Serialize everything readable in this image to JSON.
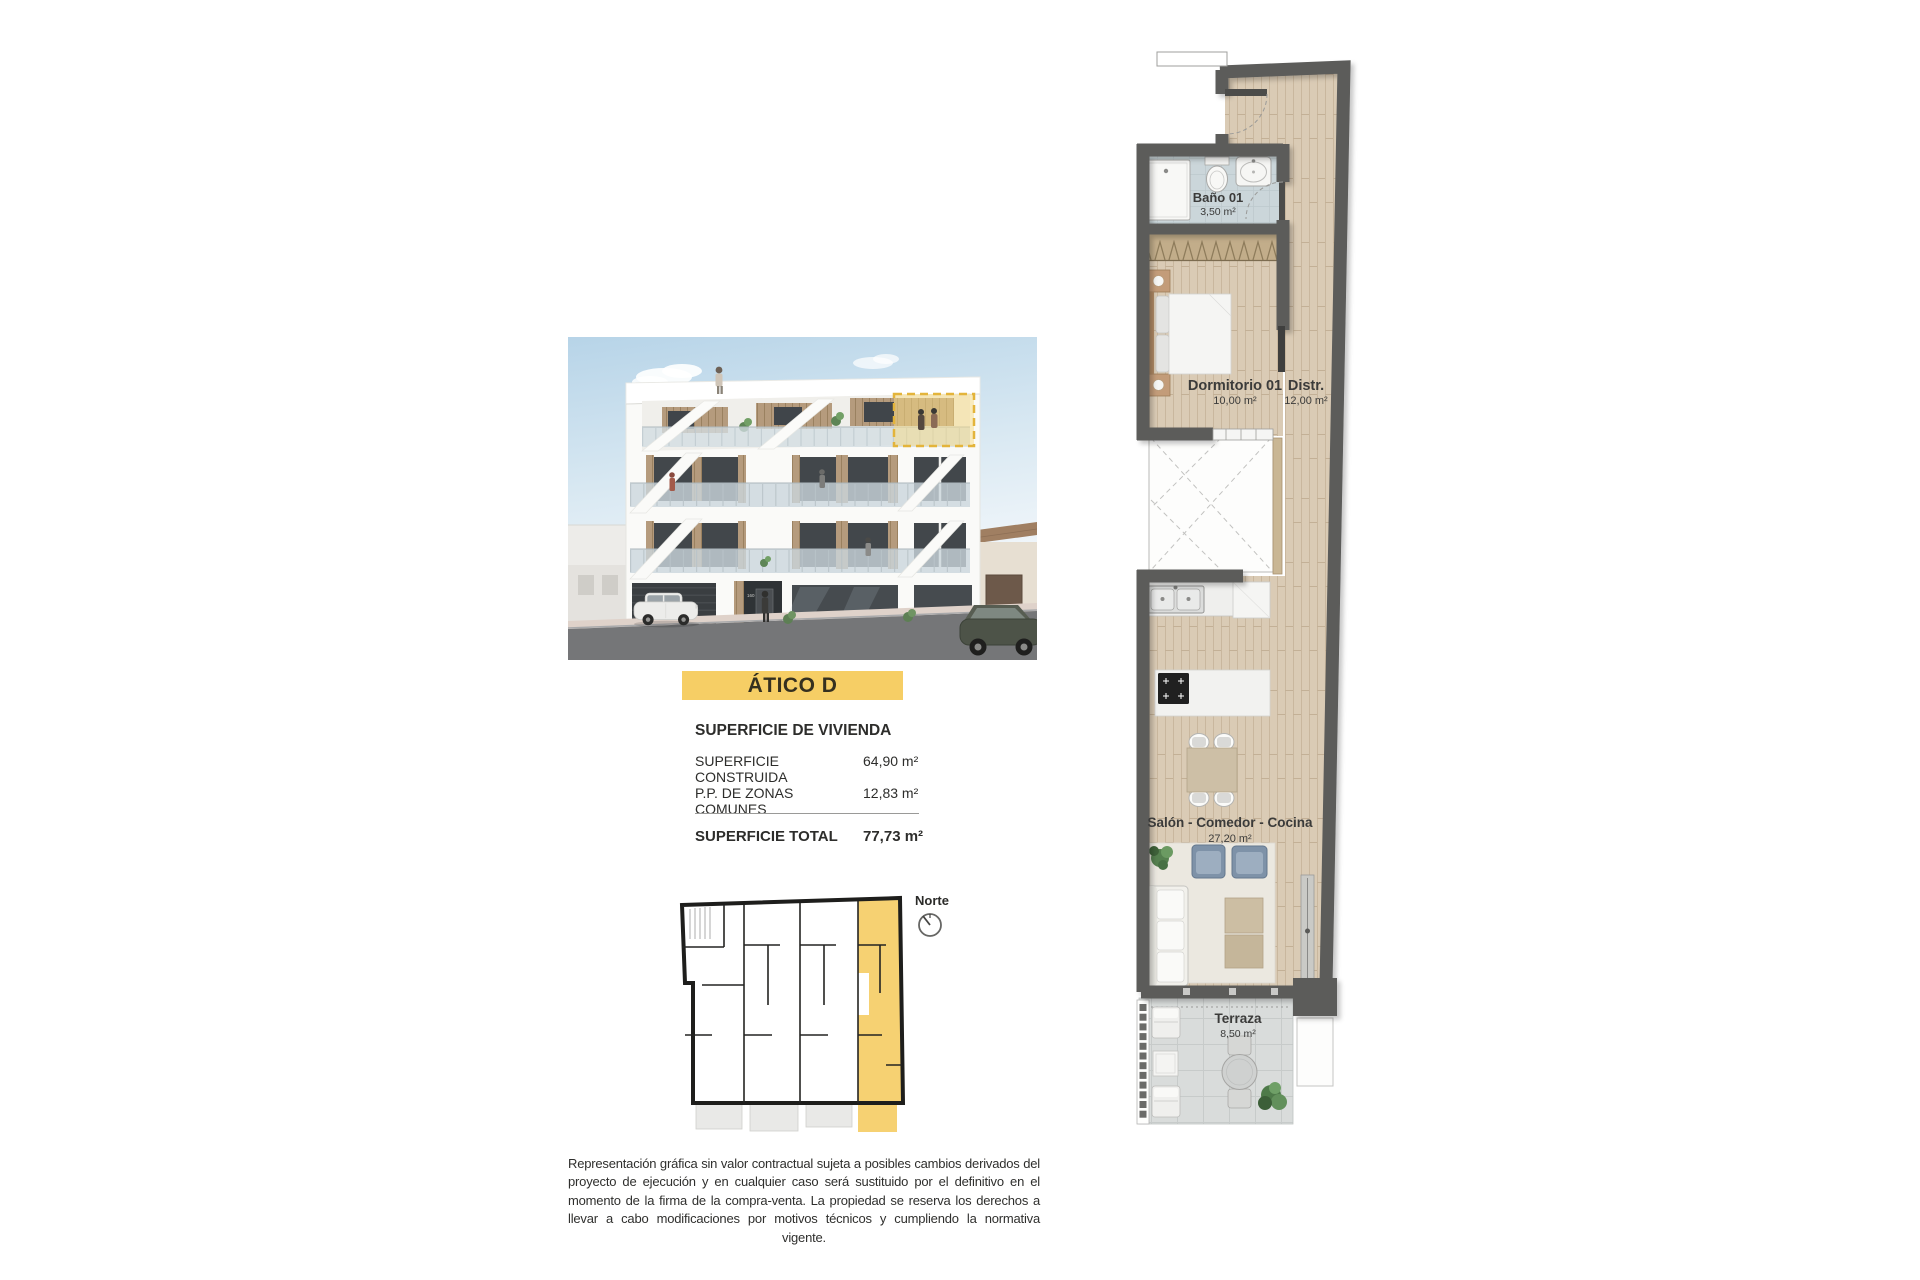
{
  "title_banner": {
    "label": "ÁTICO D"
  },
  "surface_panel": {
    "header": "SUPERFICIE DE VIVIENDA",
    "rows": [
      {
        "label": "SUPERFICIE CONSTRUIDA",
        "value": "64,90 m²"
      },
      {
        "label": "P.P. DE ZONAS COMUNES",
        "value": "12,83 m²"
      }
    ],
    "total": {
      "label": "SUPERFICIE TOTAL",
      "value": "77,73 m²"
    }
  },
  "floor_plan": {
    "rooms": [
      {
        "name": "Baño 01",
        "area": "3,50 m²"
      },
      {
        "name": "Dormitorio 01",
        "area": "10,00 m²"
      },
      {
        "name": "Distr.",
        "area": "12,00 m²"
      },
      {
        "name": "Salón - Comedor - Cocina",
        "area": "27,20 m²"
      },
      {
        "name": "Terraza",
        "area": "8,50 m²"
      }
    ]
  },
  "key_plan": {
    "compass_label": "Norte"
  },
  "building_render": {
    "entrance_number": "160"
  },
  "disclaimer": "Representación gráfica sin valor contractual sujeta a posibles cambios derivados del proyecto de ejecución y en cualquier caso será sustituido por el definitivo en el momento de la firma de la compra-venta. La propiedad se reserva los derechos a llevar a cabo modificaciones por motivos técnicos y cumpliendo la normativa vigente.",
  "colors": {
    "accent_yellow": "#F6CE65",
    "unit_highlight_yellow": "#F6D172",
    "plan_wall_grey": "#5B5B5A",
    "wood_floor": "#DACBB5",
    "bath_floor": "#CBD6DA",
    "terrace_tile": "#D9DCDB",
    "armchair_blue": "#7E92A8"
  }
}
